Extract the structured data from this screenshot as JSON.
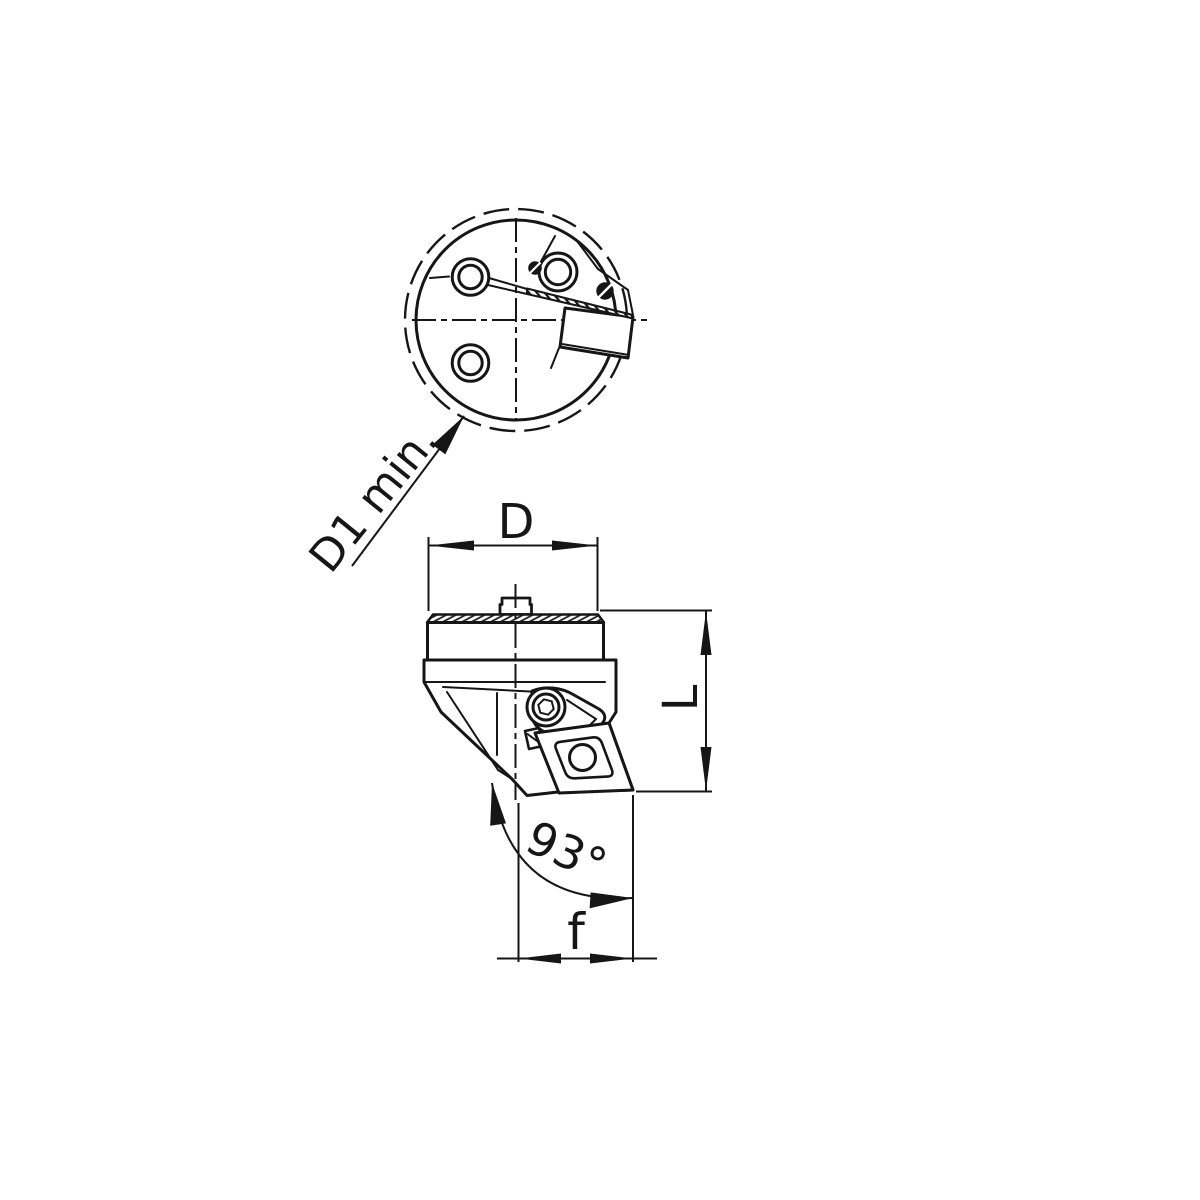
{
  "page": {
    "background": "#ffffff",
    "line_color": "#161616",
    "kind": "technical drawing of a 93-degree turning tool cutting head, two views"
  },
  "labels": {
    "d1_min": "D1 min.",
    "d": "D",
    "l": "L",
    "angle": "93°",
    "f": "f"
  }
}
